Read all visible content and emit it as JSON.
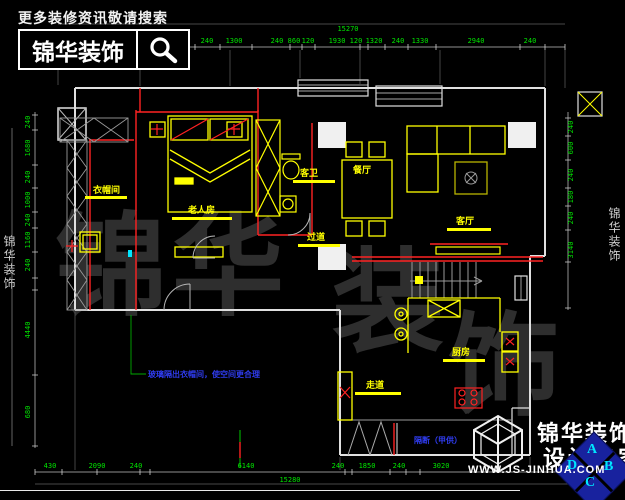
{
  "header": {
    "search_hint": "更多装修资讯敬请搜索",
    "brand": "锦华装饰"
  },
  "watermark": {
    "chars": [
      "锦",
      "华",
      "装",
      "饰"
    ],
    "side_left": "锦华装饰",
    "side_right": "锦华装饰"
  },
  "rooms": {
    "cloakroom": "衣帽间",
    "elder_bedroom": "老人房",
    "guest_bath": "客卫",
    "dining": "餐厅",
    "living": "客厅",
    "hallway": "过道",
    "kitchen": "厨房",
    "corridor": "走道"
  },
  "notes": {
    "glass_partition": "玻璃隔出衣帽间，使空间更合理",
    "partition_supplied": "隔断（甲供）"
  },
  "dimensions": {
    "top": {
      "total": "15270",
      "segments": [
        "1380",
        "240",
        "1300",
        "240",
        "860",
        "120",
        "1930",
        "120",
        "1320",
        "240",
        "1330",
        "2940",
        "240"
      ]
    },
    "bottom": {
      "total": "15280",
      "segments": [
        "430",
        "2090",
        "240",
        "6140",
        "240",
        "1850",
        "240",
        "3020"
      ]
    },
    "left": {
      "segments": [
        "240",
        "1680",
        "240",
        "1000",
        "240",
        "1160",
        "240",
        "4440",
        "680"
      ]
    },
    "right": {
      "segments": [
        "240",
        "600",
        "240",
        "180",
        "240",
        "3140"
      ]
    }
  },
  "footer": {
    "brand_line1": "锦华装饰",
    "brand_line2": "设计专家",
    "website": "WWW.JS-JINHUA.COM",
    "compass": {
      "n": "A",
      "w": "D",
      "e": "B",
      "s": "C"
    }
  },
  "colors": {
    "background": "#000000",
    "wall": "#e0e0e0",
    "partition": "#ff2222",
    "furniture": "#ffff00",
    "dimension_text": "#00e400",
    "note_text": "#2f3cf0",
    "compass_bg": "#18229e",
    "compass_letter": "#00e5ff"
  }
}
